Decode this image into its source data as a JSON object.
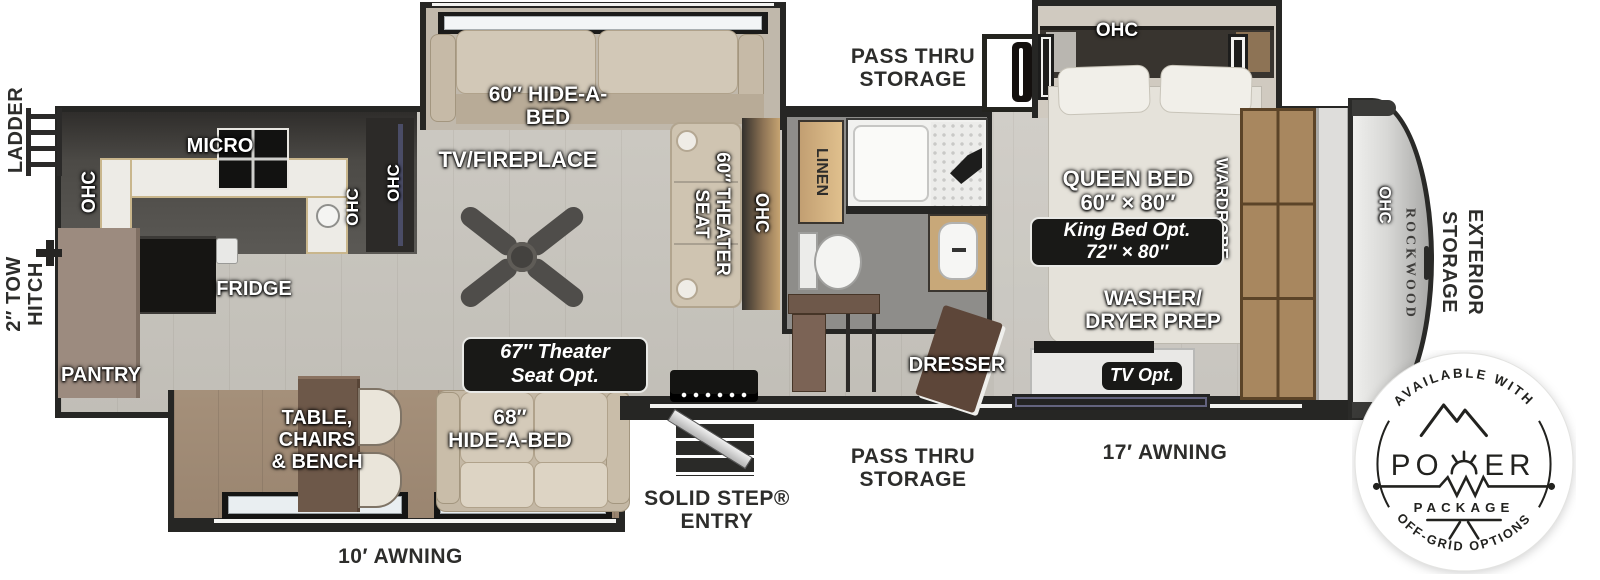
{
  "colors": {
    "wall": "#262624",
    "floor": "#c9c6bf",
    "wood": "#a8875f",
    "badge_bg": "#191917",
    "ink": "#2d2d2b"
  },
  "exterior": {
    "ladder": "LADDER",
    "tow_hitch": "2″ TOW\nHITCH",
    "pass_thru_storage_top": "PASS THRU\nSTORAGE",
    "pass_thru_storage_bottom": "PASS THRU\nSTORAGE",
    "solid_step_entry": "SOLID STEP®\nENTRY",
    "awning_17": "17′ AWNING",
    "awning_10": "10′ AWNING",
    "exterior_storage": "EXTERIOR\nSTORAGE"
  },
  "interior": {
    "ohc": "OHC",
    "micro": "MICRO",
    "fridge": "FRIDGE",
    "pantry": "PANTRY",
    "tv_fireplace": "TV/FIREPLACE",
    "hide_a_bed_60": "60″ HIDE-A-\nBED",
    "theater_seat_60": "60″ THEATER\nSEAT",
    "linen": "LINEN",
    "table_chairs_bench": "TABLE,\nCHAIRS\n& BENCH",
    "hide_a_bed_68": "68″\nHIDE-A-BED",
    "queen_bed": "QUEEN BED\n60″ × 80″",
    "wardrobe": "WARDROBE",
    "washer_dryer_prep": "WASHER/\nDRYER PREP",
    "dresser": "DRESSER"
  },
  "options": {
    "theater_seat_opt": "67″ Theater\nSeat Opt.",
    "king_bed_opt": "King Bed Opt.\n72″ × 80″",
    "tv_opt": "TV Opt."
  },
  "brand": {
    "rockwood": "ROCKWOOD"
  },
  "power_badge": {
    "arc_top": "AVAILABLE WITH",
    "word_left": "PO",
    "word_right": "ER",
    "package": "PACKAGE",
    "arc_bottom": "OFF-GRID OPTIONS"
  }
}
